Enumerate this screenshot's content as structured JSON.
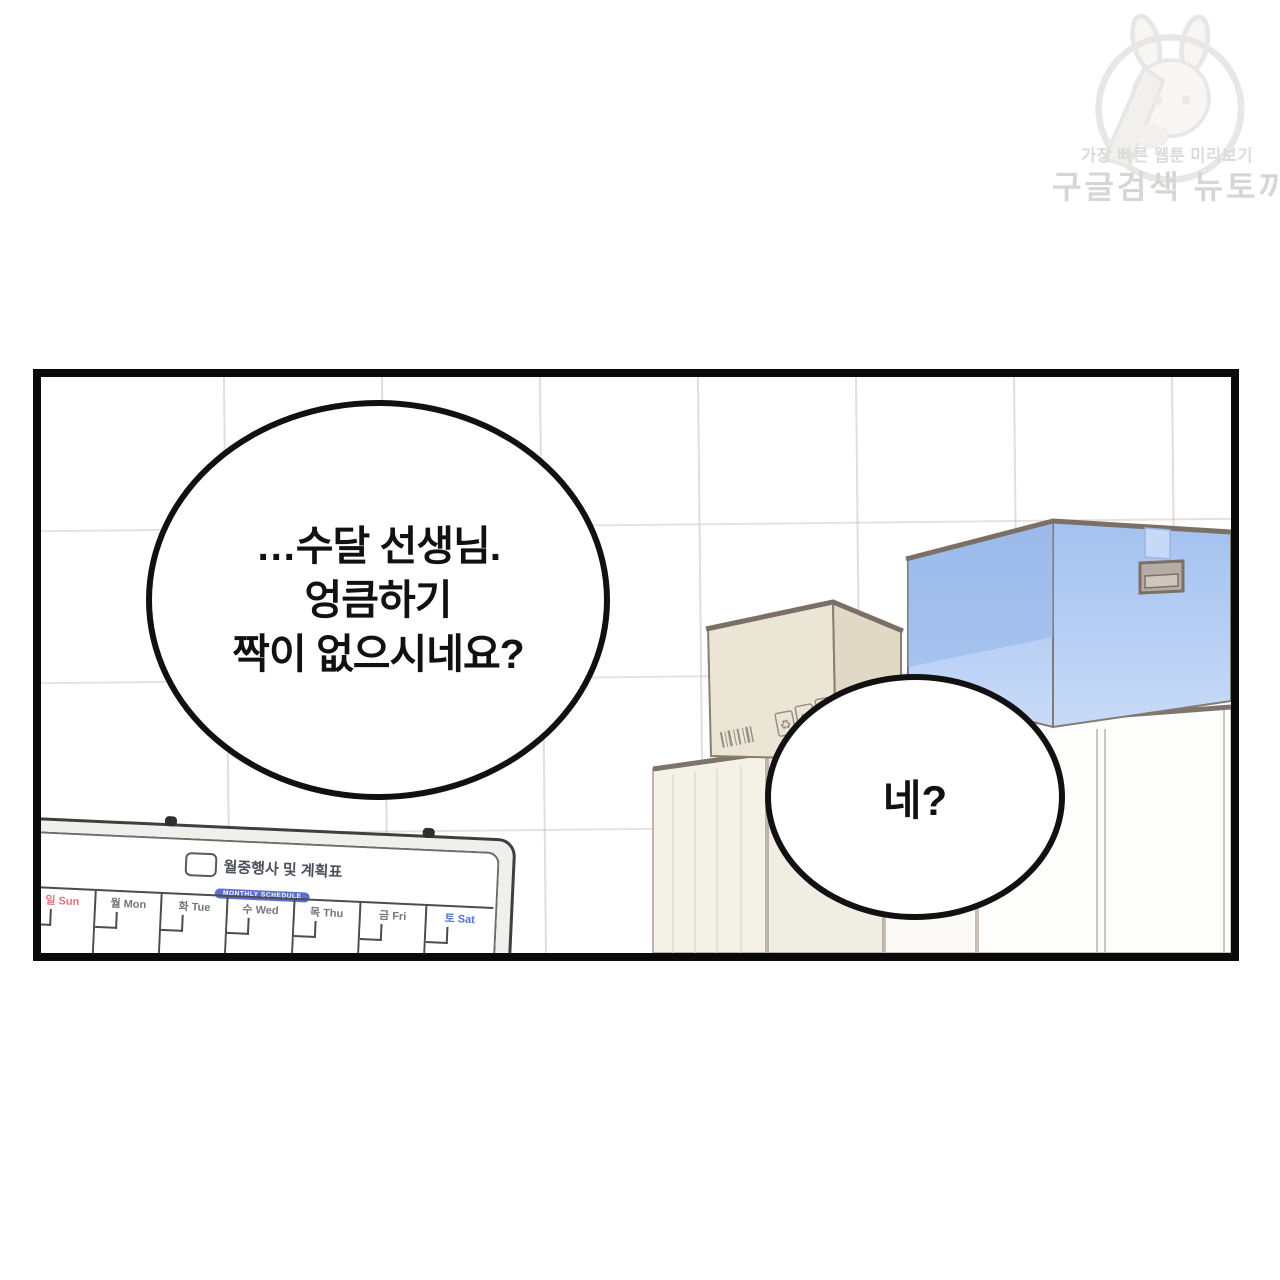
{
  "watermark": {
    "tagline": "가장 빠른 웹툰 미리보기",
    "brand": "구글검색 뉴토끼"
  },
  "panel": {
    "bubble_main": {
      "lines": [
        "…수달 선생님.",
        "엉큼하기",
        "짝이 없으시네요?"
      ]
    },
    "bubble_reply": {
      "text": "네?"
    },
    "icons": {
      "recycle": "♻",
      "this_side_up": "⇈"
    },
    "whiteboard": {
      "title": "월중행사 및 계획표",
      "subtitle": "MONTHLY SCHEDULE",
      "days": [
        {
          "label": "일 Sun",
          "color": "#e2737c"
        },
        {
          "label": "월 Mon",
          "color": "#76767a"
        },
        {
          "label": "화 Tue",
          "color": "#76767a"
        },
        {
          "label": "수 Wed",
          "color": "#76767a"
        },
        {
          "label": "목 Thu",
          "color": "#76767a"
        },
        {
          "label": "금 Fri",
          "color": "#76767a"
        },
        {
          "label": "토 Sat",
          "color": "#5577d2"
        }
      ]
    },
    "colors": {
      "panel_border": "#0a0a0a",
      "tile_line": "#e9e2de",
      "blue_box": "#9bb9ea",
      "cardboard_box": "#ebe5d5",
      "cabinet_cream": "#f4f1e7",
      "cabinet_white": "#fdfdfc",
      "outline": "#857a72"
    }
  }
}
